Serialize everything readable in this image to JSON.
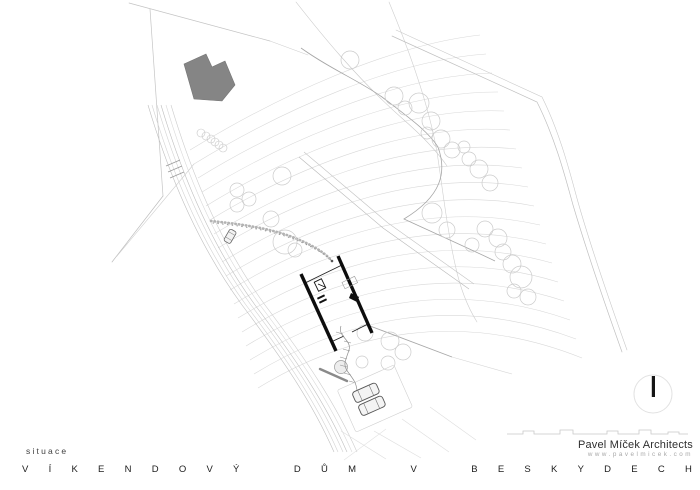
{
  "drawing": {
    "label": "situace",
    "studio": "Pavel Míček Architects",
    "website": "www.pavelmicek.com"
  },
  "title": {
    "text": "VÍKENDOVÝ DŮM V BESKYDECH",
    "words": [
      "VÍKENDOVÝ",
      "DŮM",
      "V",
      "BESKYDECH"
    ]
  },
  "colors": {
    "existing_building_fill": "#858585",
    "house_walls": "#0d0d0d",
    "contour_lines": "#d8d8d8",
    "boundary_lines": "#c0c0c0",
    "tree_outline": "#cbcbcb",
    "title_text": "#1c1c1c",
    "url_text": "#a8a8a8"
  }
}
